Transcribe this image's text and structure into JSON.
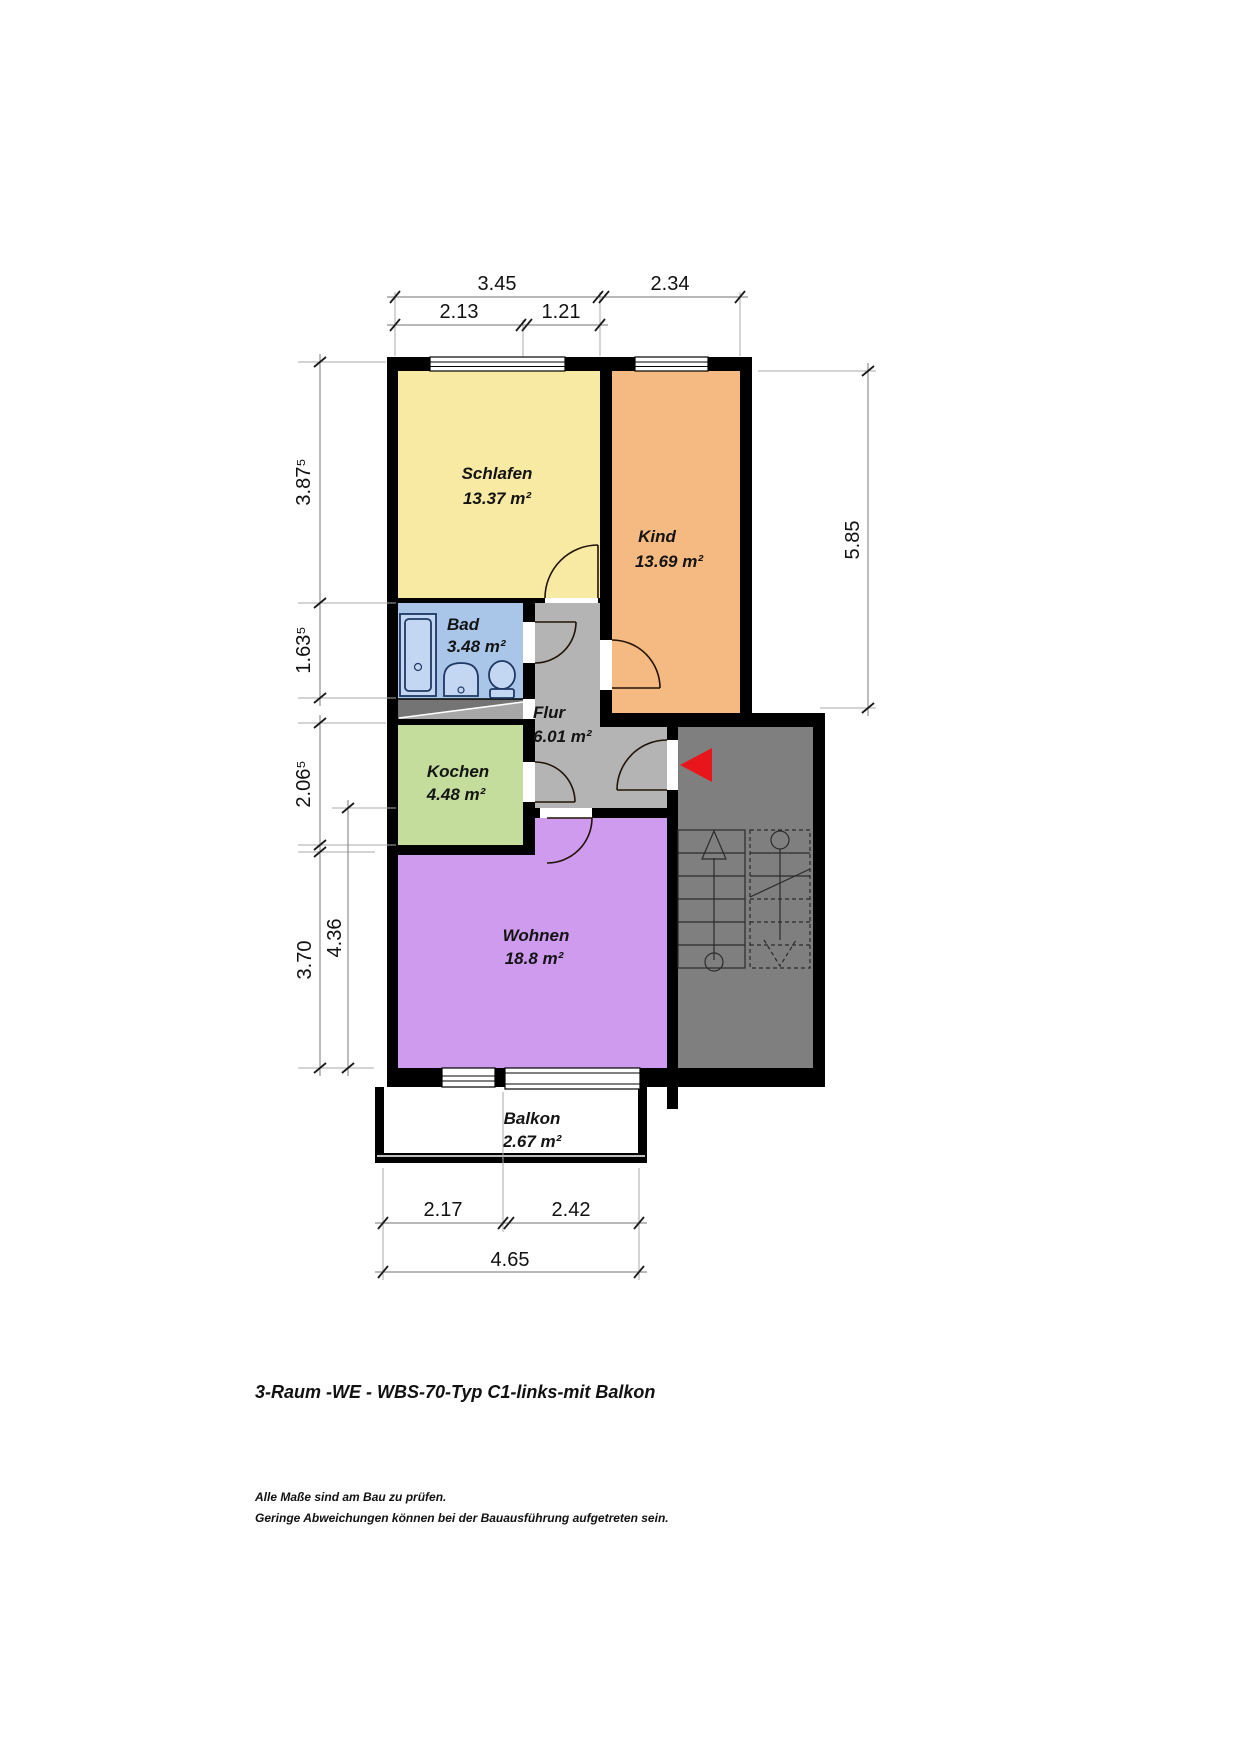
{
  "page": {
    "title": "3-Raum -WE - WBS-70-Typ C1-links-mit Balkon",
    "notes": [
      "Alle Maße sind am Bau zu prüfen.",
      "Geringe Abweichungen können bei der Bauausführung aufgetreten sein."
    ]
  },
  "rooms": [
    {
      "name": "Schlafen",
      "area": "13.37 m²",
      "color": "#F8E9A3"
    },
    {
      "name": "Kind",
      "area": "13.69 m²",
      "color": "#F5BA81"
    },
    {
      "name": "Bad",
      "area": "3.48 m²",
      "color": "#A9C6E9"
    },
    {
      "name": "Flur",
      "area": "6.01 m²",
      "color": "#B4B4B4"
    },
    {
      "name": "Kochen",
      "area": "4.48 m²",
      "color": "#C5DD9C"
    },
    {
      "name": "Wohnen",
      "area": "18.8 m²",
      "color": "#CE9BEE"
    },
    {
      "name": "Balkon",
      "area": "2.67 m²",
      "color": "#FFFFFF"
    }
  ],
  "dims": {
    "top": [
      "3.45",
      "2.34"
    ],
    "top_sub": [
      "2.13",
      "1.21"
    ],
    "left": [
      "3.87⁵",
      "1.63⁵",
      "2.06⁵",
      "3.70"
    ],
    "left_inner": "4.36",
    "right": "5.85",
    "bottom_sub": [
      "2.17",
      "2.42"
    ],
    "bottom": "4.65"
  },
  "colors": {
    "wall": "#000000",
    "stairwell": "#7F7F7F",
    "shaft_dark": "#747474",
    "shaft_light": "#A7A7A7",
    "entry_arrow": "#E8151B"
  }
}
